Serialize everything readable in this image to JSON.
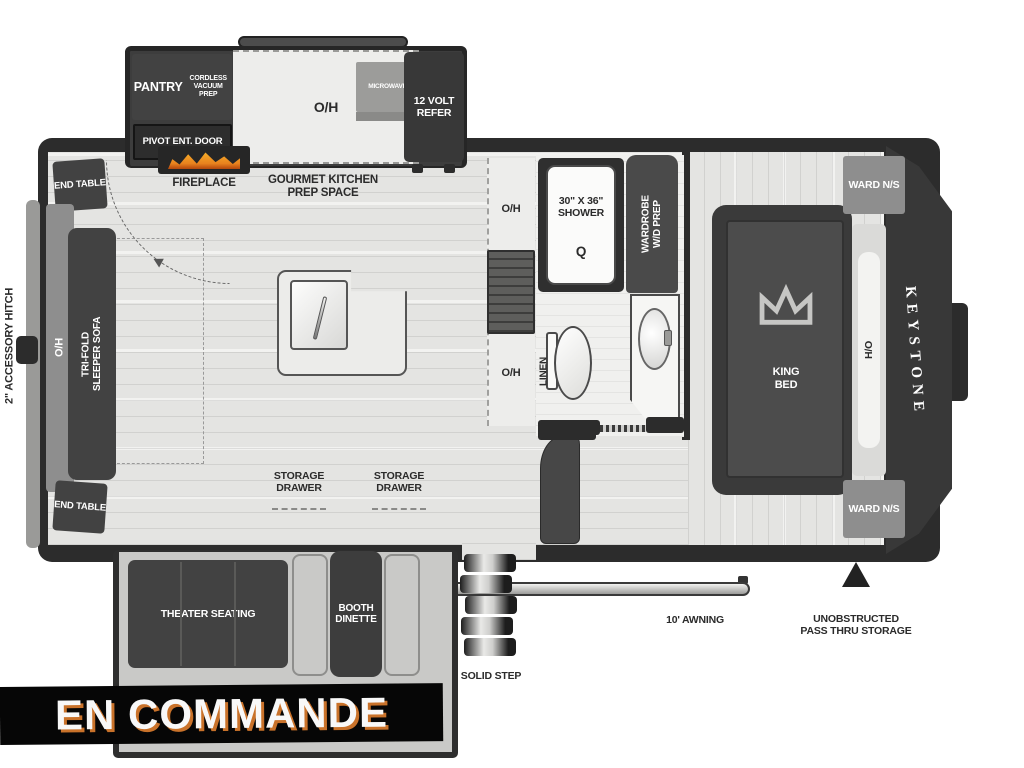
{
  "banner": {
    "text": "EN COMMANDE"
  },
  "exterior": {
    "hitch": "2\" ACCESSORY HITCH",
    "brand": "KEYSTONE",
    "solid_step": "SOLID STEP",
    "awning": "10' AWNING",
    "pass_thru": "UNOBSTRUCTED PASS THRU STORAGE"
  },
  "front_living": {
    "end_table_top": "END TABLE",
    "end_table_bottom": "END TABLE",
    "overhead": "O/H",
    "sofa": "TRI-FOLD\nSLEEPER SOFA",
    "theater": "THEATER SEATING",
    "dinette": "BOOTH DINETTE"
  },
  "kitchen": {
    "pantry": "PANTRY",
    "vacuum": "CORDLESS VACUUM PREP",
    "overhead": "O/H",
    "microwave": "MICROWAVE",
    "refer": "12 VOLT REFER",
    "entry_door": "PIVOT ENT. DOOR",
    "fireplace": "FIREPLACE",
    "gourmet": "GOURMET KITCHEN PREP SPACE",
    "storage_drawer_left": "STORAGE DRAWER",
    "storage_drawer_right": "STORAGE DRAWER",
    "counter_oh_top": "O/H",
    "counter_oh_bottom": "O/H"
  },
  "bathroom": {
    "shower_label": "30\" X 36\"\nSHOWER",
    "shower_symbol": "Q",
    "wardrobe": "WARDROBE\nW/D PREP",
    "linen": "LINEN"
  },
  "bedroom": {
    "ward_top": "WARD N/S",
    "bed": "KING BED",
    "headboard": "H/O",
    "ward_bottom": "WARD N/S"
  },
  "colors": {
    "wall": "#2c2c2c",
    "dark": "#424242",
    "floor": "#e4e4e2",
    "floor_light": "#ededeb",
    "gray": "#8e8e8e",
    "bench": "#c9c9c7",
    "banner_bg": "#060606",
    "banner_text": "#f8f8f8",
    "banner_shadow": "#c9722a",
    "flame": "#e8821e"
  }
}
